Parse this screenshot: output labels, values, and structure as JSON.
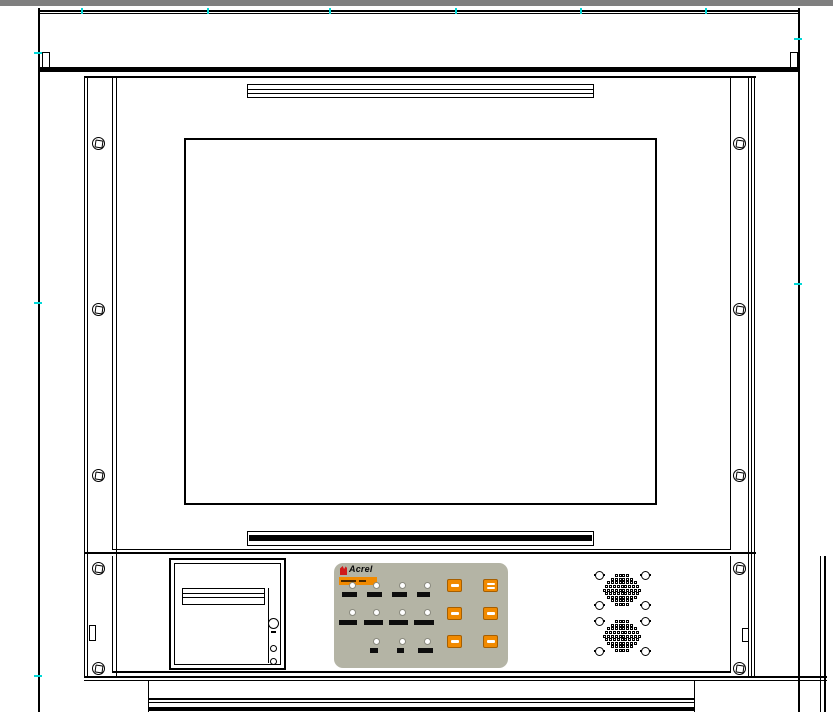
{
  "colors": {
    "outline": "#000000",
    "top_bar": "#7f7f7f",
    "panel_beige": "#b4b4a5",
    "button_orange": "#f18a00",
    "button_orange_border": "#a65e00",
    "brand_red": "#cf1a1a",
    "marker_cyan": "#00d8d8",
    "led_ring": "#8a8a7f",
    "label_dark": "#0d0d0d",
    "badge_text_dark": "#4a2800"
  },
  "brand": {
    "name": "Acrel"
  },
  "frame_screws": {
    "left_x": 98,
    "right_x": 739,
    "ys": [
      143,
      309,
      475,
      568,
      668
    ]
  },
  "markers": {
    "top_x": [
      81,
      207,
      329,
      455,
      580,
      705
    ],
    "left_y": [
      52,
      302,
      675
    ],
    "right_y": [
      38,
      283
    ]
  },
  "control_panel": {
    "leds": [
      {
        "x": 18,
        "y": 22
      },
      {
        "x": 42,
        "y": 22
      },
      {
        "x": 68,
        "y": 22
      },
      {
        "x": 93,
        "y": 22
      },
      {
        "x": 18,
        "y": 49
      },
      {
        "x": 42,
        "y": 49
      },
      {
        "x": 68,
        "y": 49
      },
      {
        "x": 93,
        "y": 49
      },
      {
        "x": 42,
        "y": 78
      },
      {
        "x": 68,
        "y": 78
      },
      {
        "x": 93,
        "y": 78
      }
    ],
    "labels": [
      {
        "x": 8,
        "y": 29,
        "w": 15
      },
      {
        "x": 33,
        "y": 29,
        "w": 15
      },
      {
        "x": 58,
        "y": 29,
        "w": 15
      },
      {
        "x": 83,
        "y": 29,
        "w": 13
      },
      {
        "x": 5,
        "y": 57,
        "w": 18
      },
      {
        "x": 30,
        "y": 57,
        "w": 19
      },
      {
        "x": 55,
        "y": 57,
        "w": 19
      },
      {
        "x": 80,
        "y": 57,
        "w": 20
      },
      {
        "x": 36,
        "y": 85,
        "w": 8
      },
      {
        "x": 63,
        "y": 85,
        "w": 7
      },
      {
        "x": 84,
        "y": 85,
        "w": 15
      }
    ],
    "buttons": [
      {
        "x": 113,
        "y": 16,
        "dashes": 1
      },
      {
        "x": 149,
        "y": 16,
        "dashes": 2
      },
      {
        "x": 113,
        "y": 44,
        "dashes": 1
      },
      {
        "x": 149,
        "y": 44,
        "dashes": 1
      },
      {
        "x": 113,
        "y": 72,
        "dashes": 1
      },
      {
        "x": 149,
        "y": 72,
        "dashes": 1
      }
    ]
  },
  "speakers": {
    "grilles": [
      {
        "cx": 509,
        "cy": 34
      },
      {
        "cx": 509,
        "cy": 80
      }
    ],
    "screw_dx": 23,
    "screw_dy": 15,
    "hole_rows": [
      4,
      6,
      8,
      9,
      10,
      9,
      8,
      6,
      4
    ],
    "pitch_x": 3.8,
    "pitch_y": 3.6
  }
}
